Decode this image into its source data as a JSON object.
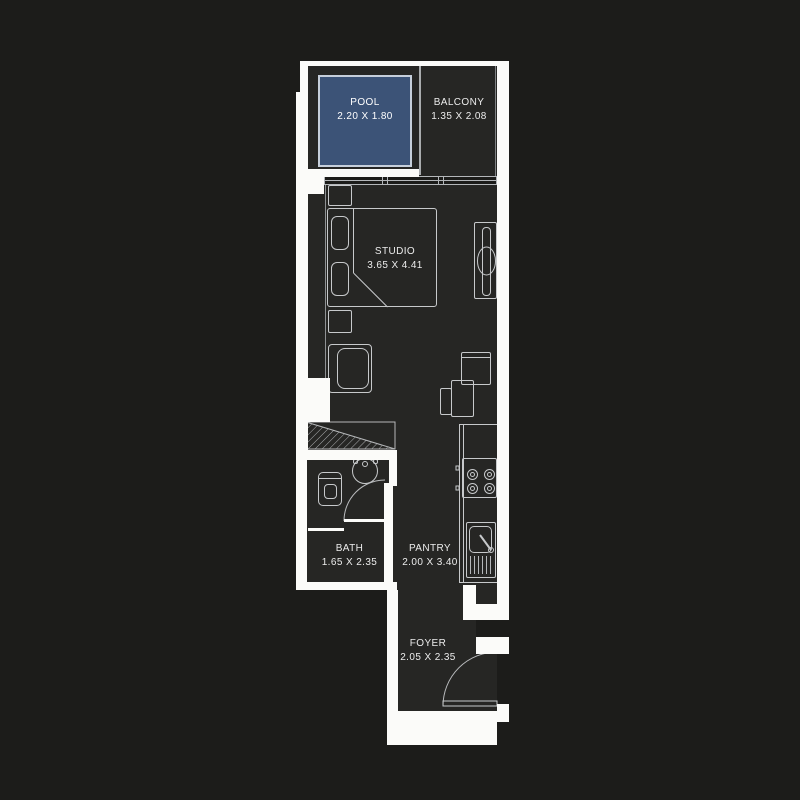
{
  "plan": {
    "rooms": [
      {
        "name": "POOL",
        "dims": "2.20 X 1.80"
      },
      {
        "name": "BALCONY",
        "dims": "1.35 X 2.08"
      },
      {
        "name": "STUDIO",
        "dims": "3.65 X 4.41"
      },
      {
        "name": "BATH",
        "dims": "1.65 X 2.35"
      },
      {
        "name": "PANTRY",
        "dims": "2.00 X 3.40"
      },
      {
        "name": "FOYER",
        "dims": "2.05 X 2.35"
      }
    ],
    "colors": {
      "background": "#1c1c1a",
      "interior": "#262624",
      "wall": "#fbfbf9",
      "linework": "#c7c9cb",
      "pool_fill": "#3c5377",
      "pool_border": "#c6cfdb",
      "label_text": "#ececec"
    }
  }
}
